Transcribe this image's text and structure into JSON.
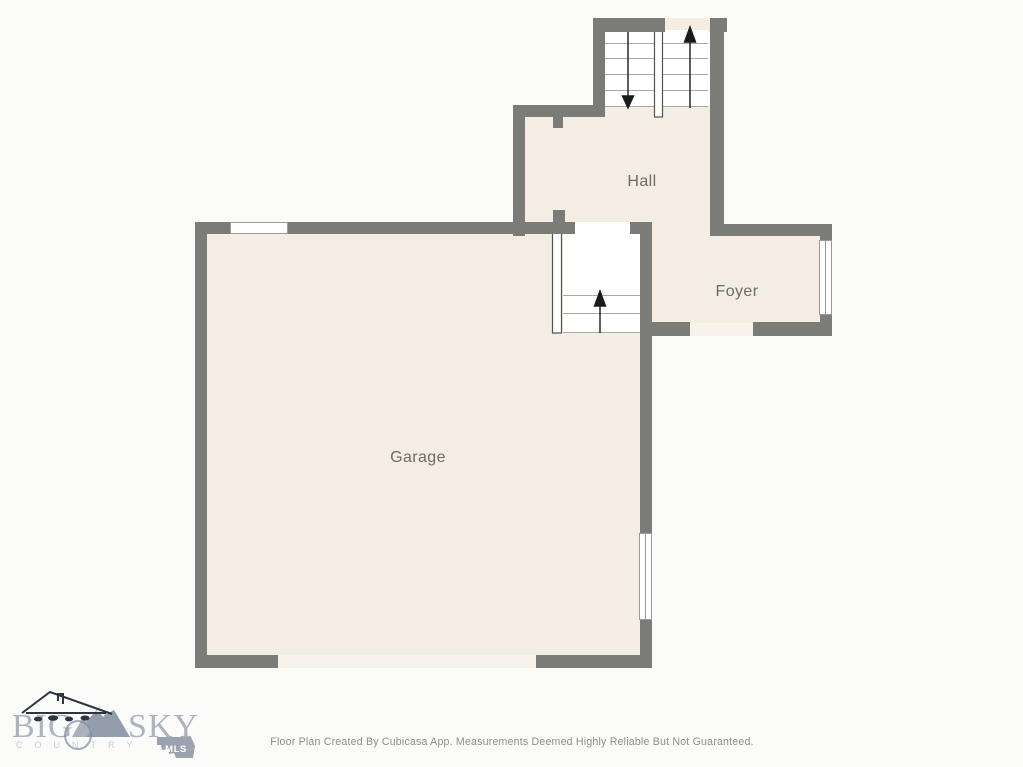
{
  "floorplan": {
    "rooms": [
      {
        "id": "hall",
        "label": "Hall"
      },
      {
        "id": "foyer",
        "label": "Foyer"
      },
      {
        "id": "garage",
        "label": "Garage"
      }
    ],
    "colors": {
      "wall": "#7b7b78",
      "floor": "#f3ede4",
      "stair_white": "#ffffff",
      "tread_line": "#a8a8a6",
      "railing_edge": "#55524e",
      "window_frame": "#9a9a96",
      "door_gap": "#f7f2ea",
      "label_text": "#6e6a64",
      "arrow": "#1a1a1a"
    }
  },
  "branding": {
    "word1": "BIG",
    "word2": "SKY",
    "subtext": "COUNTRY",
    "badge_label": "MLS",
    "colors": {
      "logo_text": "#a5abb9",
      "logo_sub": "#c8ccd3",
      "badge_fill": "#9ba3b0",
      "badge_text": "#ffffff",
      "house_line": "#2e3540",
      "mountain_fill": "#939cab"
    }
  },
  "footer": {
    "disclaimer": "Floor Plan Created By Cubicasa App. Measurements Deemed Highly Reliable But Not Guaranteed."
  }
}
